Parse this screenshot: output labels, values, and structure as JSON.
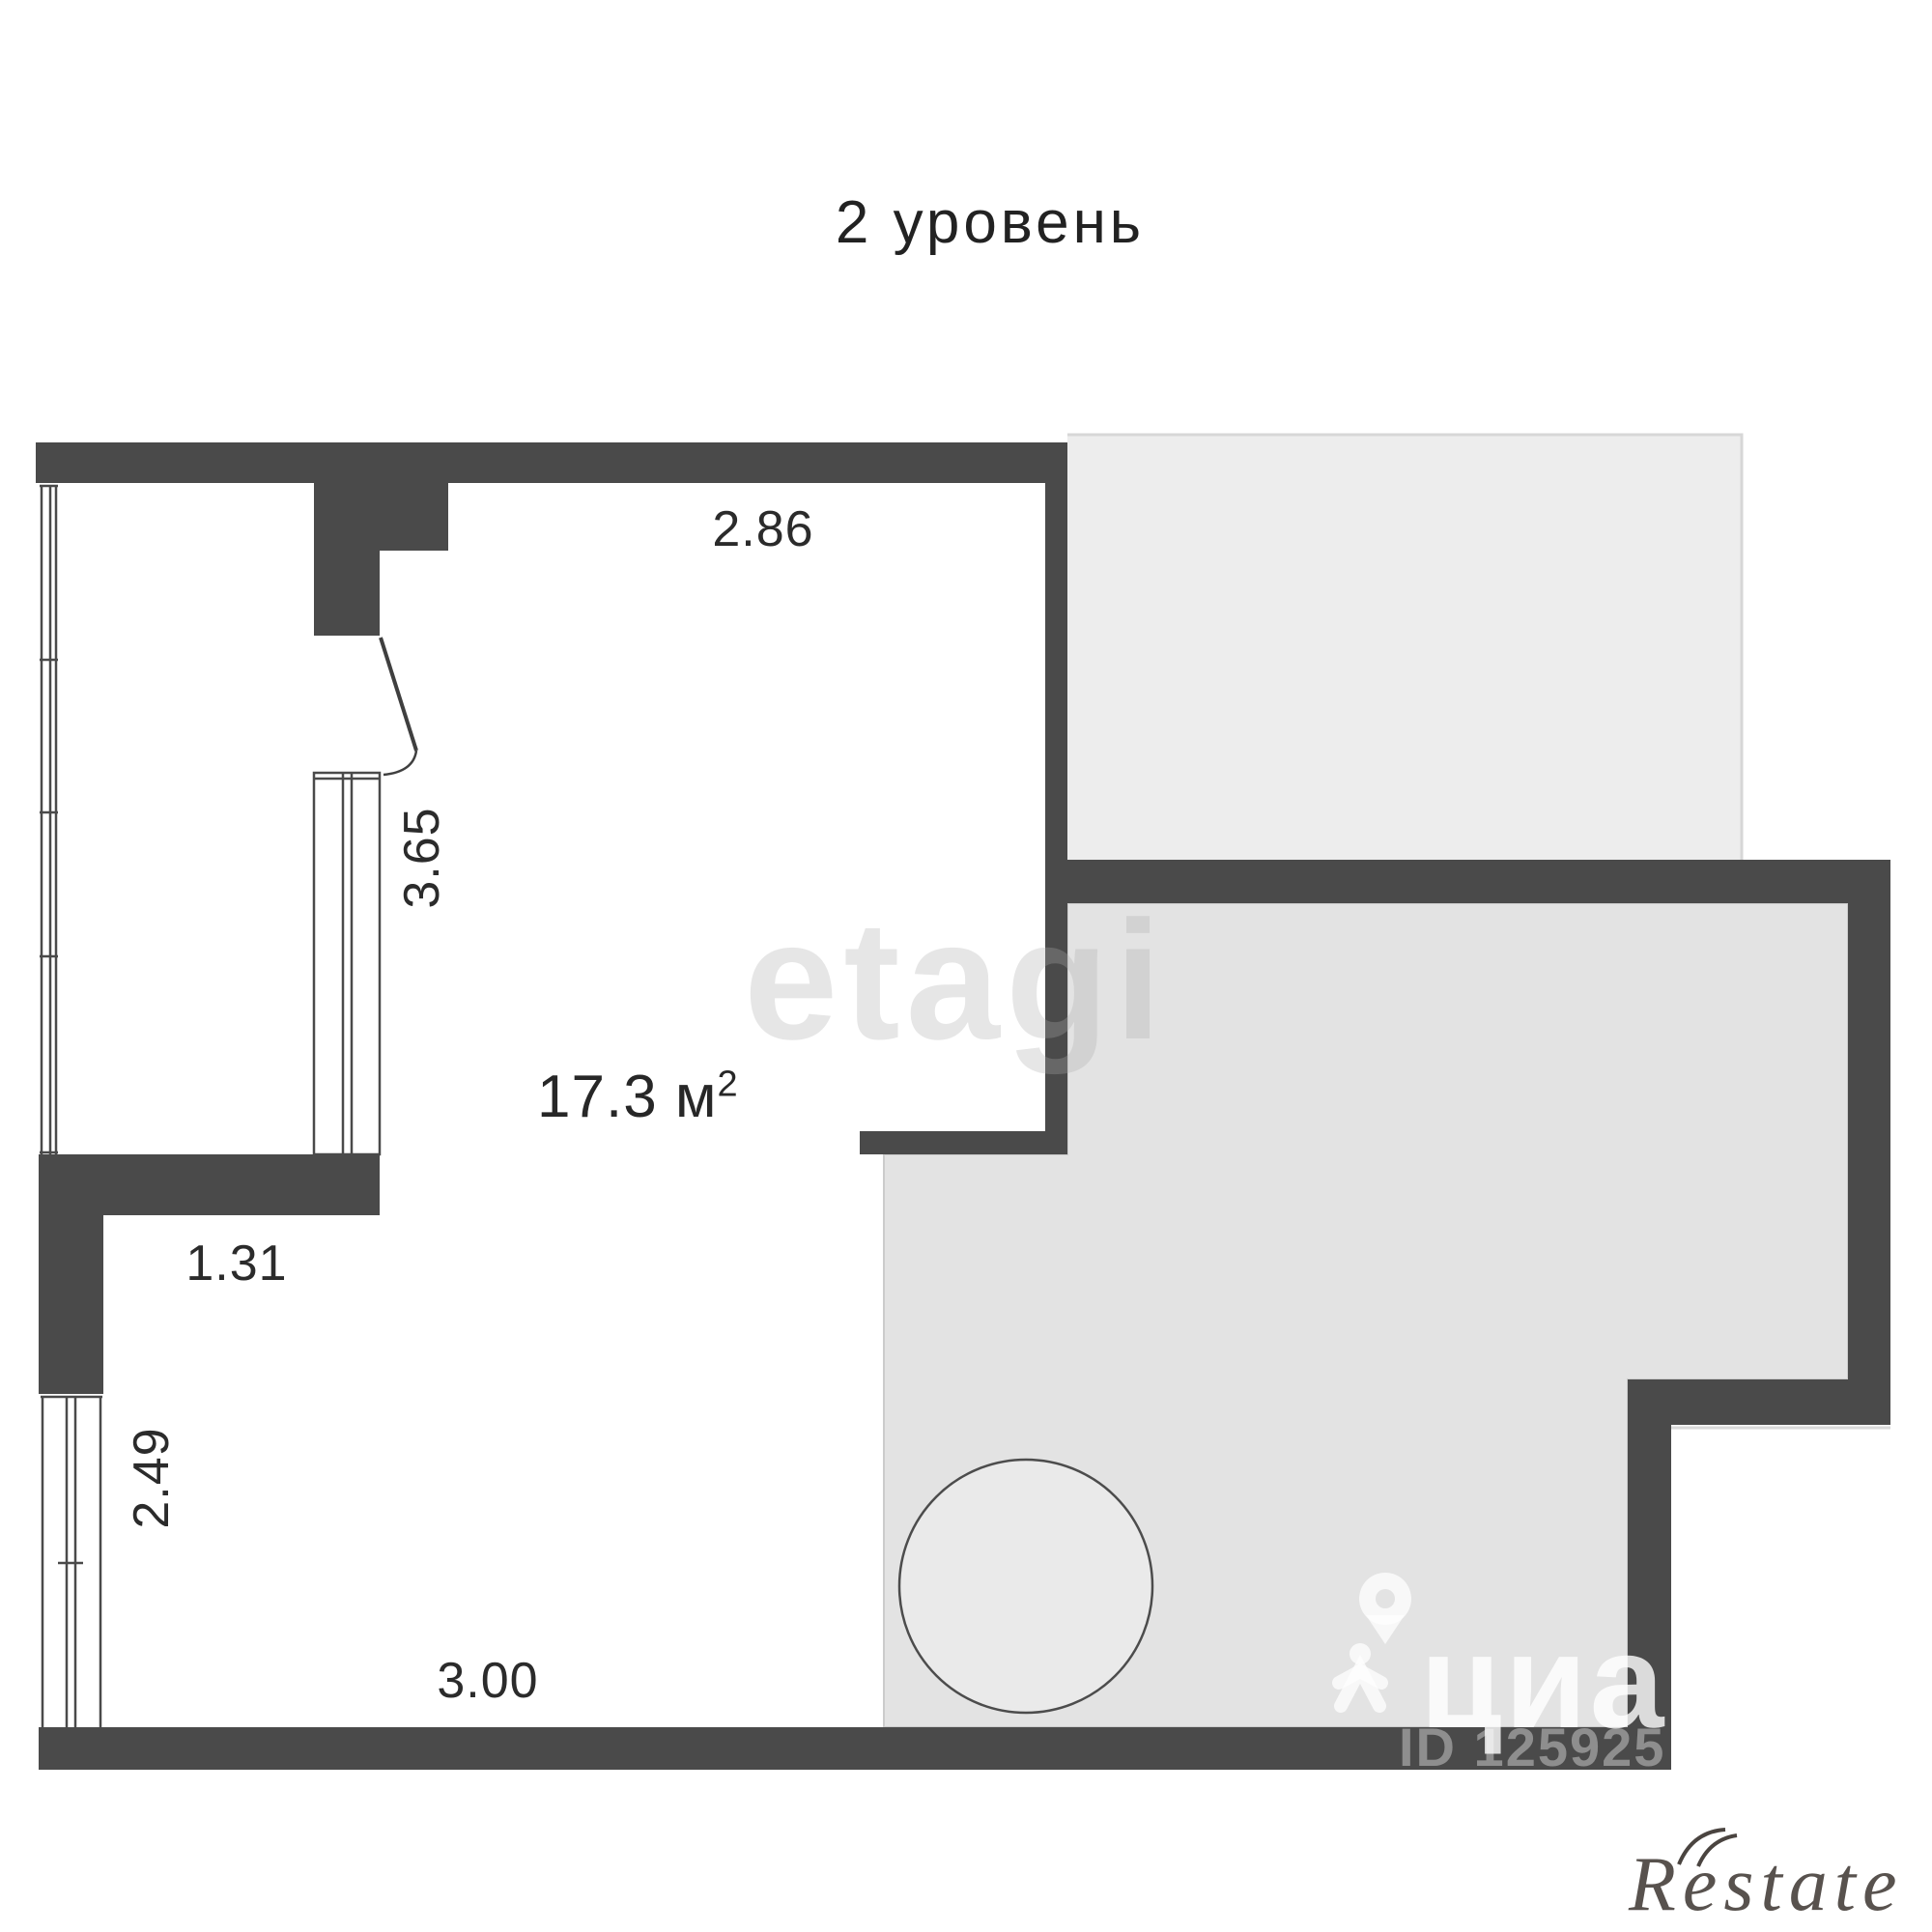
{
  "title": "2 уровень",
  "area": {
    "value": "17.3",
    "unit": "м",
    "power": "2"
  },
  "dimensions": {
    "top_wall": "2.86",
    "window_left": "3.65",
    "ledge": "1.31",
    "window_lower_left": "2.49",
    "bottom_wall": "3.00"
  },
  "watermarks": {
    "center_brand": "etagi",
    "portal_brand": "циан",
    "listing_id": "ID 125925",
    "corner_brand": "Restate"
  },
  "colors": {
    "wall": "#4a4a4a",
    "background": "#ffffff",
    "neighbor_area_upper": "#ededed",
    "neighbor_area_lower": "#e3e3e3",
    "circle_fill": "#eaeaea",
    "label_text": "#2b2b2b"
  }
}
